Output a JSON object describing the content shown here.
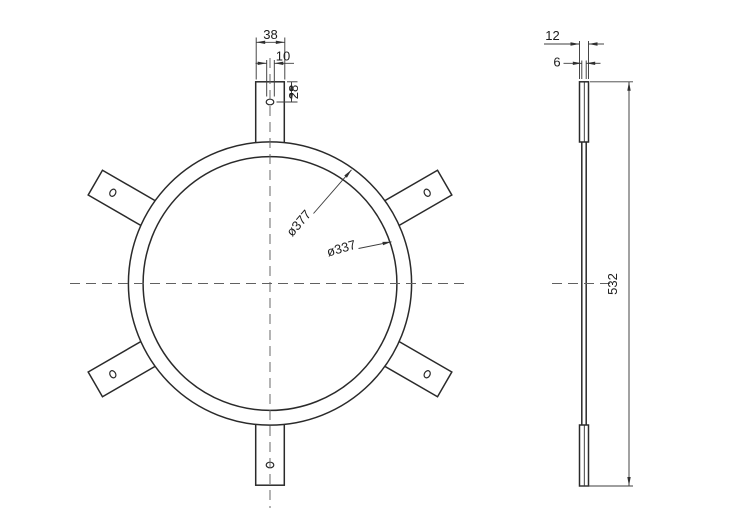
{
  "drawing": {
    "kind": "2D engineering drawing, ring flange with six mounting tabs, front and side views",
    "dims": {
      "front": {
        "tab_width": "38",
        "hole_diameter": "10",
        "hole_offset": "28",
        "outer_diameter": "ø377",
        "inner_diameter": "ø337"
      },
      "side": {
        "overlap_thickness": "12",
        "plate_thickness": "6",
        "overall_height": "532"
      }
    },
    "counts": {
      "mounting_tabs": 6,
      "tab_holes": 6
    },
    "colors": {
      "background": "#ffffff",
      "object_line": "#2a2a2a",
      "dimension_line": "#3d3d3d",
      "centerline": "#616161",
      "text": "#1c1c1c"
    }
  }
}
